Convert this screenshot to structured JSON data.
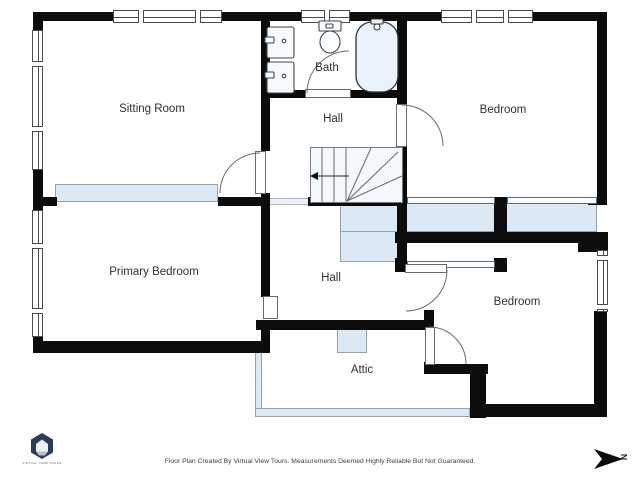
{
  "rooms": {
    "sitting_room": "Sitting Room",
    "bath": "Bath",
    "hall_upper": "Hall",
    "bedroom_upper": "Bedroom",
    "primary_bedroom": "Primary Bedroom",
    "hall_lower": "Hall",
    "bedroom_lower": "Bedroom",
    "attic": "Attic"
  },
  "compass": {
    "label": "N"
  },
  "branding": {
    "logo_text": "VIRTUAL VIEW TOURS"
  },
  "footer": {
    "disclaimer": "Floor Plan Created By Virtual View Tours. Measurements Deemed Highly Reliable But Not Guaranteed."
  },
  "colors": {
    "wall": "#0c0c0c",
    "glass_fill": "#dbe9f4",
    "line": "#4a4a4a",
    "logo": "#2b3c5e"
  }
}
